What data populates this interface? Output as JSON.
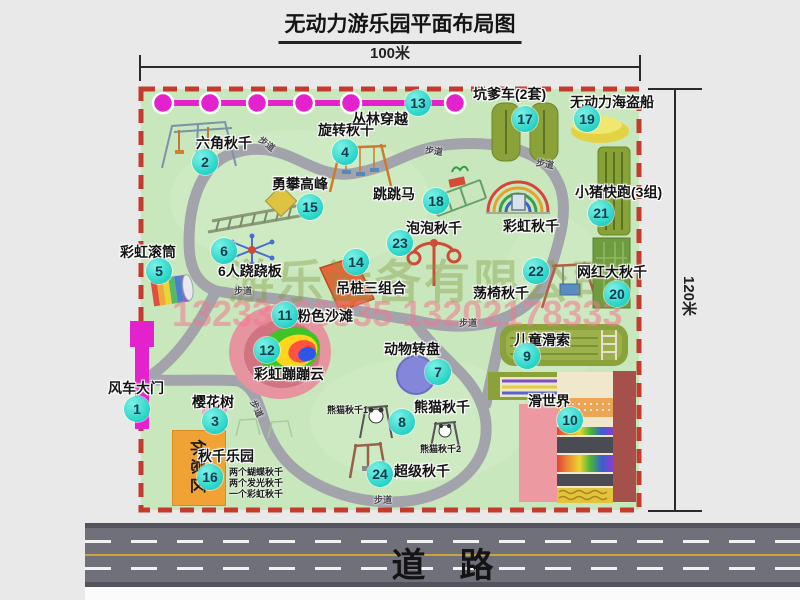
{
  "title": "无动力游乐园平面布局图",
  "dimensions": {
    "horizontal": "100米",
    "vertical": "120米"
  },
  "watermark": {
    "company": "游乐设备有限公司",
    "phone": "13233860535 13202178333"
  },
  "road": {
    "label": "道路"
  },
  "rest_area": {
    "label": "休息区"
  },
  "trail_label": "步道",
  "attractions": [
    {
      "num": "1",
      "name": "风车大门"
    },
    {
      "num": "2",
      "name": "六角秋千"
    },
    {
      "num": "3",
      "name": "樱花树"
    },
    {
      "num": "4",
      "name": "旋转秋千"
    },
    {
      "num": "5",
      "name": "彩虹滚筒"
    },
    {
      "num": "6",
      "name": "6人跷跷板"
    },
    {
      "num": "7",
      "name": "动物转盘"
    },
    {
      "num": "8",
      "name": "熊猫秋千"
    },
    {
      "num": "9",
      "name": "儿童滑索"
    },
    {
      "num": "10",
      "name": "滑世界"
    },
    {
      "num": "11",
      "name": "粉色沙滩"
    },
    {
      "num": "12",
      "name": "彩虹蹦蹦云"
    },
    {
      "num": "13",
      "name": "丛林穿越"
    },
    {
      "num": "14",
      "name": "吊桩三组合"
    },
    {
      "num": "15",
      "name": "勇攀高峰"
    },
    {
      "num": "16",
      "name": "秋千乐园"
    },
    {
      "num": "17",
      "name": "坑爹车(2套)"
    },
    {
      "num": "18",
      "name": "跳跳马"
    },
    {
      "num": "19",
      "name": "无动力海盗船"
    },
    {
      "num": "20",
      "name": "网红大秋千"
    },
    {
      "num": "21",
      "name": "小猪快跑(3组)"
    },
    {
      "num": "22",
      "name": "荡椅秋千"
    },
    {
      "num": "23",
      "name": "泡泡秋千"
    },
    {
      "num": "24",
      "name": "超级秋千"
    },
    {
      "num": "",
      "name": "彩虹秋千"
    }
  ],
  "sub_labels": {
    "panda1": "熊猫秋千1",
    "panda2": "熊猫秋千2"
  },
  "swing_park_notes": [
    "两个蝴蝶秋千",
    "两个发光秋千",
    "一个彩虹秋千"
  ],
  "colors": {
    "map_bg": "#c8e7bd",
    "boundary": "#c43b2e",
    "marker": "#2fd8cd",
    "zipline_gate": "#e322cd",
    "road": "#70707b",
    "rest_area": "#f0a235"
  }
}
